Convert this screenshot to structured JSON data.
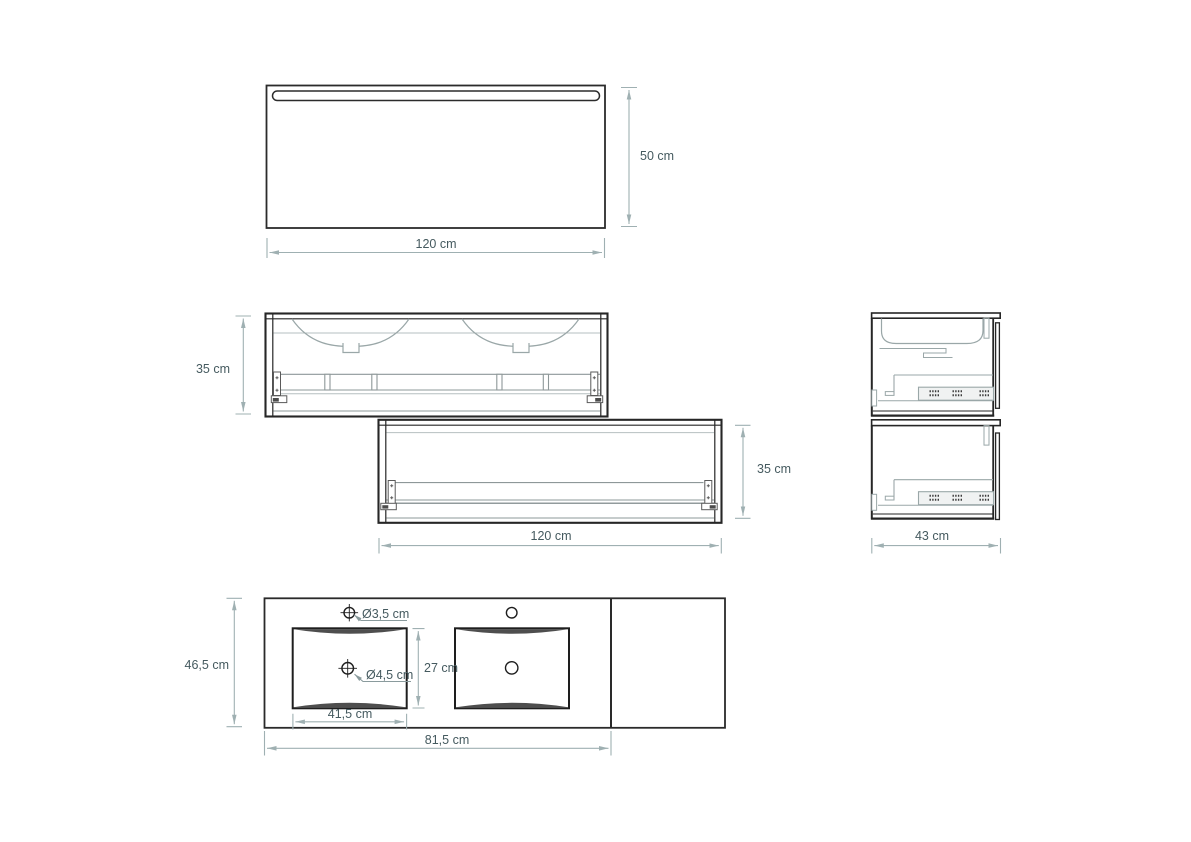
{
  "drawing_colors": {
    "outline": "#262626",
    "inner_detail": "#9aa7a8",
    "dimension_line": "#9fb0b2",
    "label_text": "#455a5f"
  },
  "labels": {
    "mirror_height": "50 cm",
    "mirror_width": "120 cm",
    "upper_cabinet_height": "35 cm",
    "lower_cabinet_height": "35 cm",
    "lower_cabinet_width": "120 cm",
    "side_view_depth": "43 cm",
    "washbasin_depth": "46,5 cm",
    "basin_inner_depth": "27 cm",
    "basin_width": "41,5 cm",
    "washbasin_width": "81,5 cm",
    "tap_hole_diameter": "Ø3,5 cm",
    "drain_hole_diameter": "Ø4,5 cm"
  }
}
